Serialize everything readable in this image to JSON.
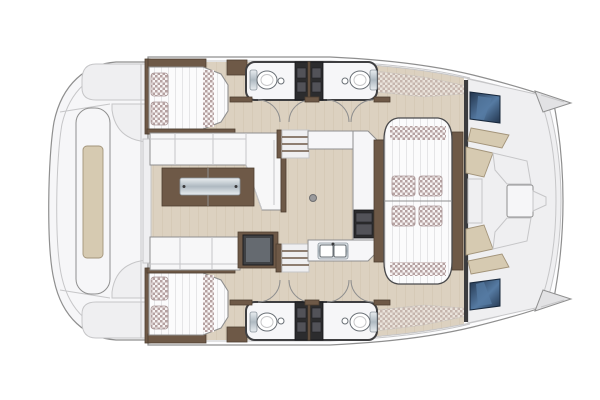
{
  "page": {
    "background": "#ffffff",
    "canvas_width": 600,
    "canvas_height": 400
  },
  "diagram": {
    "type": "floor-plan",
    "subject": "catamaran-yacht-interior-layout",
    "view": "top-down",
    "orientation": "bow-right-stern-left",
    "components": [
      "hull",
      "aft-cockpit",
      "aft-lounge-bench",
      "aft-side-panel",
      "port-cabin-bed",
      "starboard-cabin-bed",
      "bed-pillows",
      "wardrobe",
      "hanging-locker",
      "port-heads",
      "starboard-heads",
      "toilet",
      "shower-locker",
      "door-swing",
      "saloon-floor",
      "l-sofa",
      "bench-sofa",
      "coffee-table",
      "tv-cabinet",
      "companionway-stairs",
      "galley-worktop",
      "stove",
      "double-sink",
      "dining-lounge",
      "lounge-cushion",
      "side-table",
      "forward-cockpit",
      "forward-seat",
      "forward-table",
      "bow-hatch",
      "sunpad-cushion",
      "bow-tip",
      "side-deck-steps"
    ]
  },
  "colors": {
    "outline": "#8f8f8f",
    "outlineSoft": "#c6c6c8",
    "outlineDark": "#4a4a4c",
    "hull": "#fdfdfe",
    "panel": "#f6f6f8",
    "panelSoft": "#efeff1",
    "floor": "#dcd1c0",
    "floorLine": "#cfc2ae",
    "wood": "#6e5947",
    "woodDark": "#4e3f30",
    "sofa": "#f7f7f8",
    "mattress": "#fbfbfc",
    "quiltLine": "#e5e5e7",
    "check": "#b5a1a1",
    "checkBg": "#f7f4f4",
    "navy": "#22344c",
    "navyLight": "#567ba3",
    "steelLight": "#e9edf0",
    "steelDark": "#aeb9c1",
    "appliance": "#2c2c2e",
    "applianceMid": "#525258",
    "cushion": "#d6cab1",
    "cushionLine": "#a3947a",
    "tvBody": "#3f4144",
    "tvScreen": "#656a70",
    "heads": "#3f3f41"
  }
}
